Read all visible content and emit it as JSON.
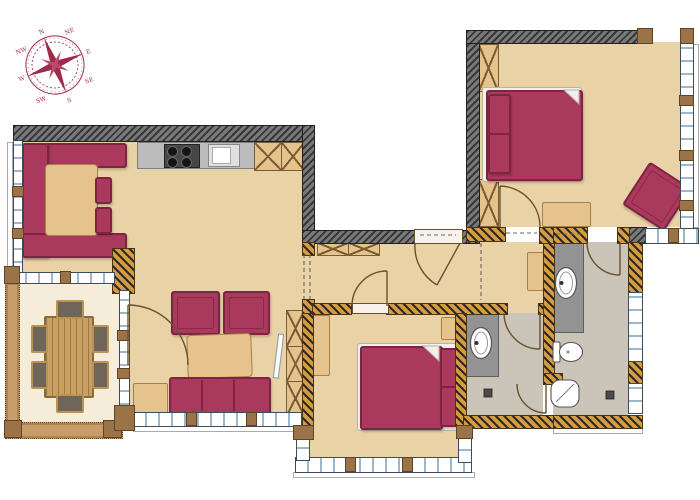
{
  "meta": {
    "type": "architectural floor plan, hand-colored top-down view",
    "units_visible": false
  },
  "compass": {
    "labels": [
      "N",
      "NE",
      "E",
      "SE",
      "S",
      "SW",
      "W",
      "NW"
    ],
    "color": "#a02a4a"
  },
  "palette": {
    "furniture_accent": "#a93a5d",
    "floor_tan": "#ead2a7",
    "floor_cream": "#f5ecda",
    "floor_bath_gray": "#cbc4b9",
    "exterior_wall": "#4a4a4a",
    "interior_wall_hatch": "#d89c40",
    "veranda_wall_wood": "#c89d68",
    "window_tick_blue": "#9db6c8",
    "counter_gray": "#bcbcbc",
    "wood": "#c9a063"
  },
  "rooms": [
    {
      "name": "kitchen-living-area",
      "floor": "tan",
      "items": [
        "corner-sofa-with-table",
        "kitchen-counter",
        "stove-4-burners",
        "kitchen-sink",
        "upper-cabinets-x2",
        "armchair-x2",
        "coffee-table",
        "three-seat-sofa",
        "side-table",
        "wall-tv",
        "shelving-unit",
        "hatched-pillar"
      ]
    },
    {
      "name": "dining-veranda",
      "floor": "cream",
      "items": [
        "dining-table",
        "dining-chairs-x6"
      ]
    },
    {
      "name": "entrance-hall",
      "floor": "tan",
      "items": [
        "entrance-door",
        "sideboard-x2",
        "wall-shelf"
      ]
    },
    {
      "name": "bedroom-1",
      "floor": "tan",
      "items": [
        "double-bed",
        "wardrobe-x2",
        "bench",
        "rotated-armchair"
      ]
    },
    {
      "name": "bedroom-2",
      "floor": "tan",
      "items": [
        "double-bed",
        "wardrobe",
        "nightstand",
        "window-bay"
      ]
    },
    {
      "name": "bathroom-1",
      "floor": "gray",
      "items": [
        "vanity-with-sink",
        "toilet",
        "bathtub",
        "floor-drain"
      ]
    },
    {
      "name": "bathroom-2",
      "floor": "gray",
      "items": [
        "vanity-with-sink",
        "floor-drain"
      ]
    }
  ]
}
